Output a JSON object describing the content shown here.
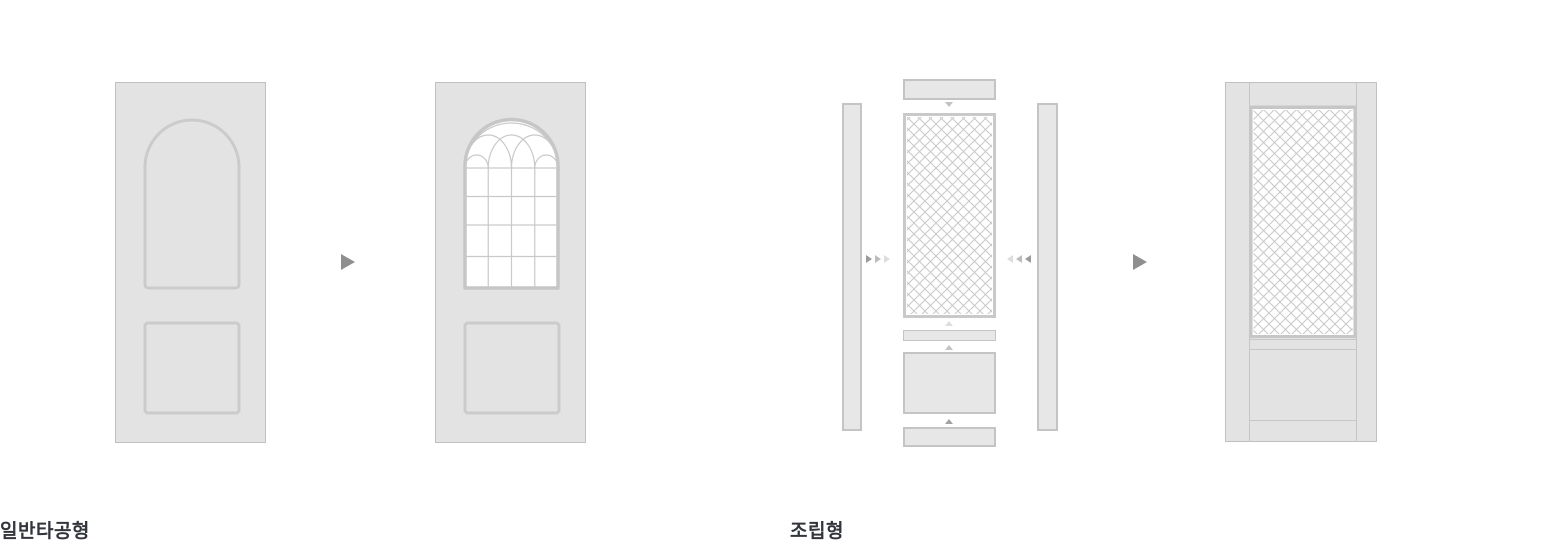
{
  "canvas": {
    "width": 1550,
    "height": 545,
    "background": "#ffffff"
  },
  "colors": {
    "door_fill": "#e3e3e3",
    "door_border": "#c0c0c0",
    "panel_outline": "#cbcbcb",
    "window_border": "#c6c6c6",
    "window_grid_line": "#c9c9c9",
    "mesh_line": "#c8c8c8",
    "part_fill": "#e7e7e7",
    "part_border": "#c4c4c4",
    "flow_arrow": "#8f8f8f",
    "label_text": "#33353c"
  },
  "sections": [
    {
      "id": "general-punched",
      "label": "일반타공형",
      "icons": [
        "right-arrow-icon"
      ]
    },
    {
      "id": "assembled",
      "label": "조립형",
      "icons": [
        "down-arrow-icon",
        "assemble-right-arrows-icon",
        "assemble-left-arrows-icon",
        "up-arrow-icon",
        "right-arrow-icon"
      ]
    }
  ]
}
